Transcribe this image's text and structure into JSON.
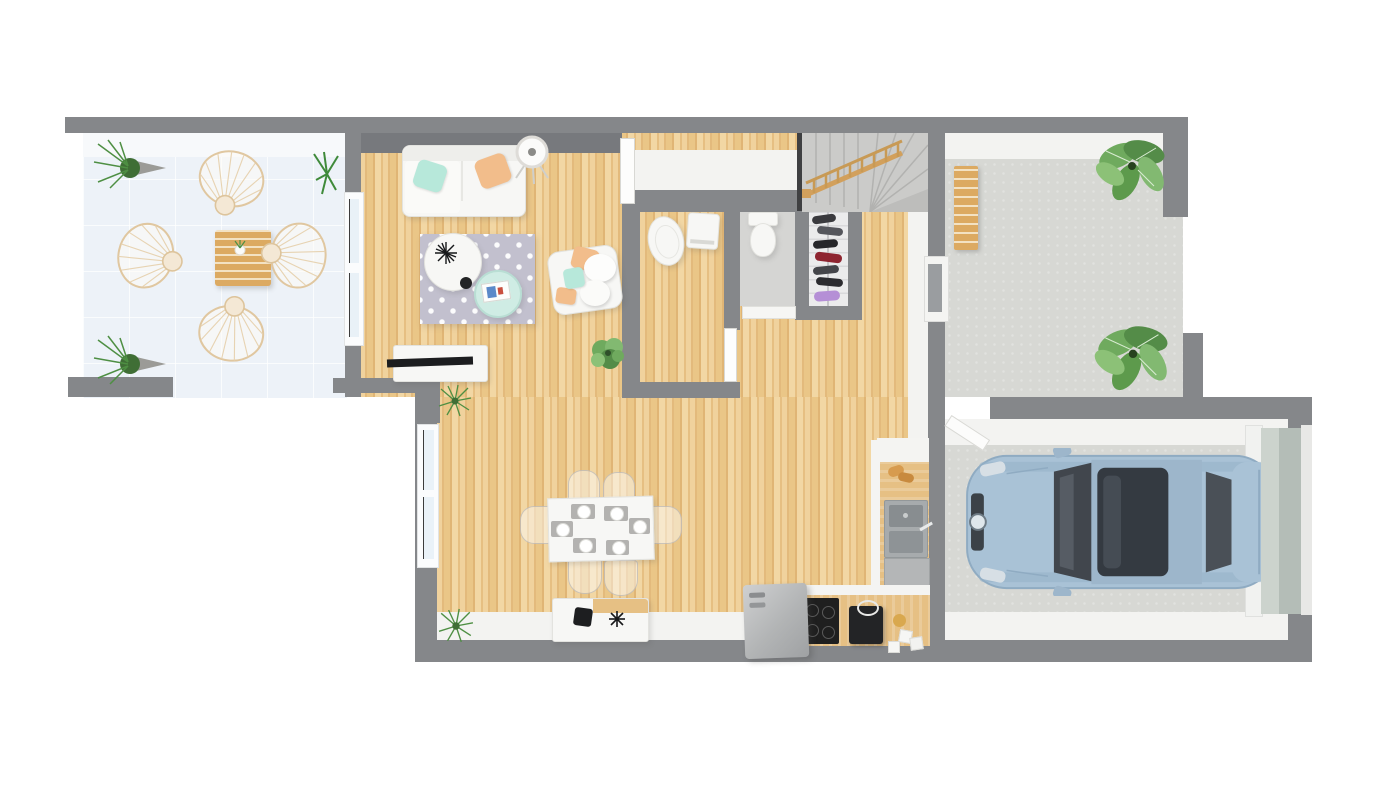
{
  "scene": {
    "type": "3d-floor-plan-top-down-render",
    "floor": "ground-floor",
    "background": "#ffffff"
  },
  "rooms": {
    "terrace": {
      "name": "Terrace",
      "furniture": [
        "rattan fan-back chair x4",
        "wooden slat lounge table",
        "cone planter grass x2",
        "small palm plant"
      ],
      "floor_color": "#edf2f8"
    },
    "living_room": {
      "name": "Living room",
      "furniture": [
        "white sofa",
        "mint cushion",
        "peach cushion",
        "round floor lamp",
        "trellis-pattern rug",
        "round white coffee table",
        "mint round side table",
        "book",
        "white armchair with cushions",
        "TV sideboard",
        "flat TV",
        "green plant"
      ],
      "floor_color": "#ebc88e"
    },
    "dining_area": {
      "name": "Dining area",
      "furniture": [
        "white dining table",
        "place setting x6",
        "clear acrylic chair x6",
        "white sideboard with decor objects"
      ]
    },
    "kitchen": {
      "name": "Kitchen",
      "furniture": [
        "L-shaped wood countertop",
        "double sink",
        "faucet",
        "dishwasher",
        "black cooktop",
        "coffee machine",
        "kettle",
        "canister x3",
        "refrigerator",
        "pastries"
      ]
    },
    "wc": {
      "name": "WC / laundry",
      "furniture": [
        "toilet",
        "washing machine"
      ],
      "floor": "wood"
    },
    "bathroom": {
      "name": "Bathroom",
      "furniture": [
        "toilet"
      ],
      "floor_color": "#d5d5d3"
    },
    "closet": {
      "name": "Shoe closet",
      "furniture": [
        "shoe shelves with shoes"
      ]
    },
    "hallway": {
      "name": "Hallway / entry",
      "furniture": [
        "open interior door"
      ]
    },
    "staircase": {
      "name": "Staircase",
      "details": [
        "gray winder stairs",
        "wooden railing with balusters"
      ]
    },
    "patio": {
      "name": "Front patio",
      "furniture": [
        "wooden bench",
        "large leafy plant x2"
      ],
      "floor_color": "#d7d8d4"
    },
    "garage": {
      "name": "Garage",
      "furniture": [
        "light blue car top view",
        "sectional garage door",
        "door to house"
      ],
      "floor_color": "#d7d8d4"
    }
  },
  "colors": {
    "wall": "#85878a",
    "wall_face": "#f3f3f1",
    "wood_light": "#f2d7a4",
    "wood_dark": "#e0b575",
    "terrace_floor": "#edf2f8",
    "rug": "#c2c0ce",
    "mint": "#b7e8da",
    "peach": "#f2bd8b",
    "stairs": "#cbcbc9",
    "railing_wood": "#d2a05c",
    "furniture_wood": "#dcaa62",
    "car_body": "#a9c2d6",
    "car_glass": "#3d434a",
    "concrete": "#d7d8d4",
    "appliance_dark": "#1f1f1f",
    "steel": "#9fa3a6",
    "plant_green": "#6faa5e",
    "grass_green": "#4e8f43",
    "shoe_red": "#8e2430",
    "shoe_purple": "#b58fd6"
  }
}
